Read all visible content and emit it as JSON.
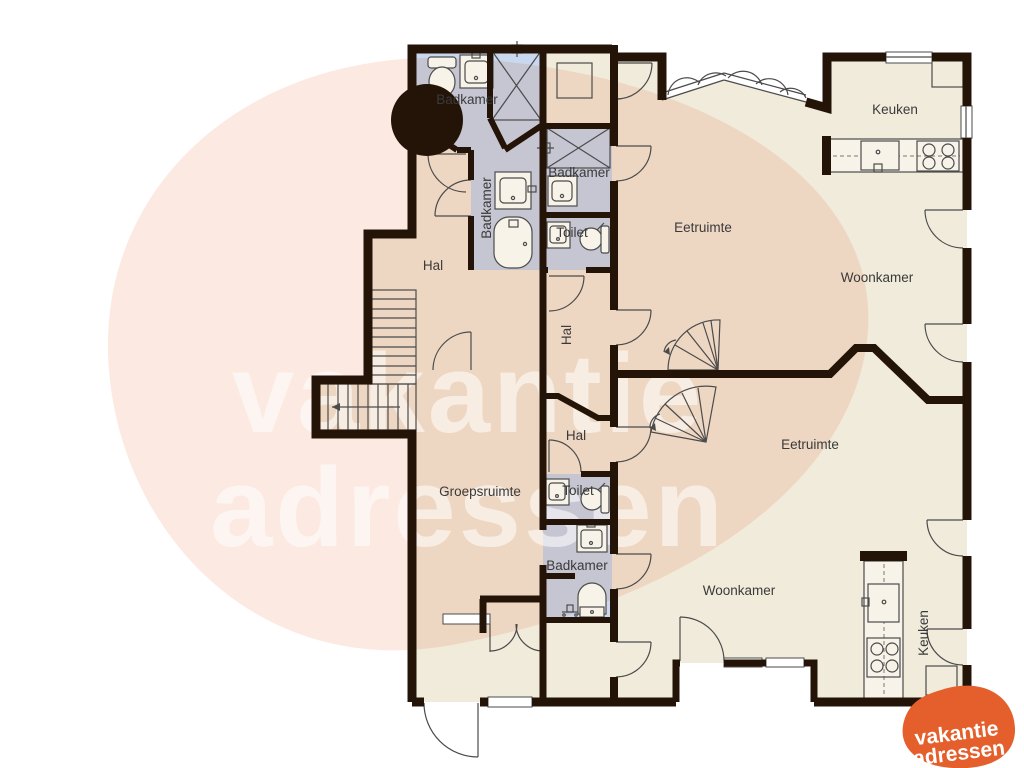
{
  "title": "Plattegrond vakantiehuis",
  "colors": {
    "wall": "#241408",
    "bathroom_fill": "#c9d8ef",
    "room_fill": "#f1ebdb",
    "label_color": "#3a3a3a",
    "watermark_blob": "#fceae2",
    "watermark_text": "#ffffff",
    "logo_orange": "#e45f2b",
    "logo_text": "#ffffff"
  },
  "rooms": [
    {
      "id": "badkamer-top-left",
      "label": "Badkamer"
    },
    {
      "id": "badkamer-mid-vertical",
      "label": "Badkamer"
    },
    {
      "id": "badkamer-2",
      "label": "Badkamer"
    },
    {
      "id": "toilet-top",
      "label": "Toilet"
    },
    {
      "id": "hal-main",
      "label": "Hal"
    },
    {
      "id": "keuken-top",
      "label": "Keuken"
    },
    {
      "id": "eetruimte-top",
      "label": "Eetruimte"
    },
    {
      "id": "woonkamer-top",
      "label": "Woonkamer"
    },
    {
      "id": "hal-mid-vertical",
      "label": "Hal"
    },
    {
      "id": "hal-2",
      "label": "Hal"
    },
    {
      "id": "eetruimte-bottom",
      "label": "Eetruimte"
    },
    {
      "id": "groepsruimte",
      "label": "Groepsruimte"
    },
    {
      "id": "toilet-bottom",
      "label": "Toilet"
    },
    {
      "id": "badkamer-bottom",
      "label": "Badkamer"
    },
    {
      "id": "woonkamer-bottom",
      "label": "Woonkamer"
    },
    {
      "id": "keuken-bottom",
      "label": "Keuken"
    }
  ],
  "watermark": {
    "line1": "vakantie",
    "line2": "adressen"
  },
  "logo": {
    "line1": "vakantie",
    "line2": "adressen"
  }
}
